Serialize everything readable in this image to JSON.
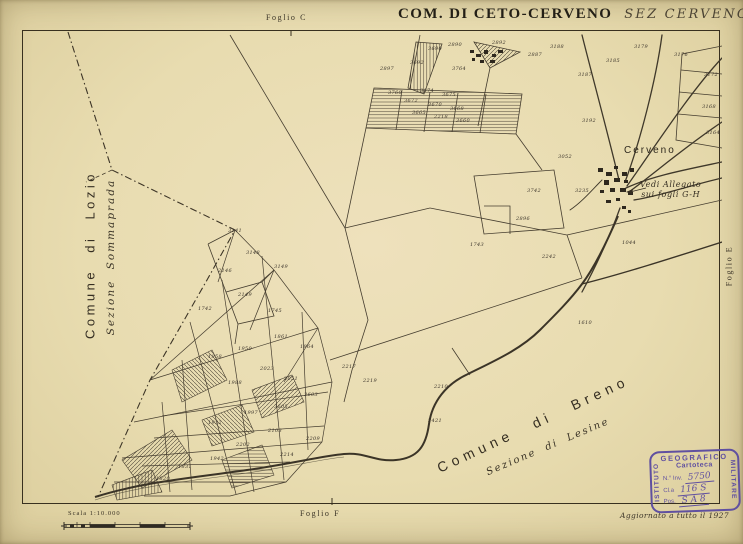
{
  "sheet": {
    "title_main": "COM. DI CETO-CERVENO",
    "title_section": "SEZ CERVENO",
    "title_sheet_no": "F.º D"
  },
  "margins": {
    "top_label": "Foglio C",
    "right_label": "Foglio E",
    "bottom_label": "Foglio F",
    "scale_label": "Scala 1:10.000",
    "revision_note": "Aggiornato a tutto il 1927"
  },
  "map": {
    "labels": {
      "comune_left": "Comune di Lozio",
      "sezione_left": "Sezione Sommaprada",
      "comune_bottom": "Comune di Breno",
      "sezione_bottom": "Sezione di Lesine",
      "village": "Cerveno",
      "annotation_line1": "Vedi Allegato",
      "annotation_line2": "sui fogli G-H"
    },
    "parcels": [
      {
        "x": 358,
        "y": 40,
        "t": "2897"
      },
      {
        "x": 406,
        "y": 20,
        "t": "3690"
      },
      {
        "x": 388,
        "y": 34,
        "t": "3692"
      },
      {
        "x": 426,
        "y": 16,
        "t": "2890"
      },
      {
        "x": 470,
        "y": 14,
        "t": "2892"
      },
      {
        "x": 506,
        "y": 26,
        "t": "2887"
      },
      {
        "x": 528,
        "y": 18,
        "t": "3188"
      },
      {
        "x": 556,
        "y": 46,
        "t": "3187"
      },
      {
        "x": 584,
        "y": 32,
        "t": "3185"
      },
      {
        "x": 612,
        "y": 18,
        "t": "3179"
      },
      {
        "x": 652,
        "y": 26,
        "t": "3176"
      },
      {
        "x": 682,
        "y": 46,
        "t": "3172"
      },
      {
        "x": 680,
        "y": 78,
        "t": "3168"
      },
      {
        "x": 684,
        "y": 104,
        "t": "3164"
      },
      {
        "x": 560,
        "y": 92,
        "t": "3192"
      },
      {
        "x": 536,
        "y": 128,
        "t": "3052"
      },
      {
        "x": 366,
        "y": 64,
        "t": "3760"
      },
      {
        "x": 398,
        "y": 62,
        "t": "3674"
      },
      {
        "x": 420,
        "y": 66,
        "t": "3675"
      },
      {
        "x": 382,
        "y": 72,
        "t": "3672"
      },
      {
        "x": 406,
        "y": 76,
        "t": "3670"
      },
      {
        "x": 428,
        "y": 80,
        "t": "3668"
      },
      {
        "x": 390,
        "y": 84,
        "t": "3665"
      },
      {
        "x": 412,
        "y": 88,
        "t": "2218"
      },
      {
        "x": 434,
        "y": 92,
        "t": "3660"
      },
      {
        "x": 430,
        "y": 40,
        "t": "3764"
      },
      {
        "x": 505,
        "y": 162,
        "t": "3742"
      },
      {
        "x": 494,
        "y": 190,
        "t": "2896"
      },
      {
        "x": 448,
        "y": 216,
        "t": "1743"
      },
      {
        "x": 520,
        "y": 228,
        "t": "2242"
      },
      {
        "x": 553,
        "y": 162,
        "t": "3235"
      },
      {
        "x": 600,
        "y": 214,
        "t": "1044"
      },
      {
        "x": 206,
        "y": 202,
        "t": "3141"
      },
      {
        "x": 224,
        "y": 224,
        "t": "3148"
      },
      {
        "x": 196,
        "y": 242,
        "t": "2146"
      },
      {
        "x": 252,
        "y": 238,
        "t": "3149"
      },
      {
        "x": 216,
        "y": 266,
        "t": "2149"
      },
      {
        "x": 176,
        "y": 280,
        "t": "1742"
      },
      {
        "x": 246,
        "y": 282,
        "t": "1745"
      },
      {
        "x": 252,
        "y": 308,
        "t": "1861"
      },
      {
        "x": 278,
        "y": 318,
        "t": "1864"
      },
      {
        "x": 216,
        "y": 320,
        "t": "1950"
      },
      {
        "x": 186,
        "y": 328,
        "t": "1958"
      },
      {
        "x": 238,
        "y": 340,
        "t": "2023"
      },
      {
        "x": 262,
        "y": 350,
        "t": "2051"
      },
      {
        "x": 206,
        "y": 354,
        "t": "1988"
      },
      {
        "x": 282,
        "y": 366,
        "t": "3603"
      },
      {
        "x": 252,
        "y": 378,
        "t": "3605"
      },
      {
        "x": 222,
        "y": 384,
        "t": "1997"
      },
      {
        "x": 186,
        "y": 394,
        "t": "1932"
      },
      {
        "x": 246,
        "y": 402,
        "t": "2103"
      },
      {
        "x": 214,
        "y": 416,
        "t": "2202"
      },
      {
        "x": 188,
        "y": 430,
        "t": "1942"
      },
      {
        "x": 156,
        "y": 438,
        "t": "1831"
      },
      {
        "x": 134,
        "y": 450,
        "t": "1820"
      },
      {
        "x": 258,
        "y": 426,
        "t": "2214"
      },
      {
        "x": 284,
        "y": 410,
        "t": "2209"
      },
      {
        "x": 320,
        "y": 338,
        "t": "2217"
      },
      {
        "x": 341,
        "y": 352,
        "t": "2219"
      },
      {
        "x": 412,
        "y": 358,
        "t": "2210"
      },
      {
        "x": 406,
        "y": 392,
        "t": "2421"
      },
      {
        "x": 556,
        "y": 294,
        "t": "1610"
      }
    ]
  },
  "stamp": {
    "org_top": "GEOGRAFICO",
    "org_left": "ISTITUTO",
    "org_right": "MILITARE",
    "subtitle": "Cartoteca",
    "fields": [
      {
        "label": "N.° Inv.",
        "value": "5750"
      },
      {
        "label": "Cl.a",
        "value": "116 S"
      },
      {
        "label": "Pos.",
        "value": "S A 8"
      }
    ]
  },
  "colors": {
    "paper": "#e8ddb2",
    "ink": "#332c20",
    "stamp": "#6050a0"
  }
}
